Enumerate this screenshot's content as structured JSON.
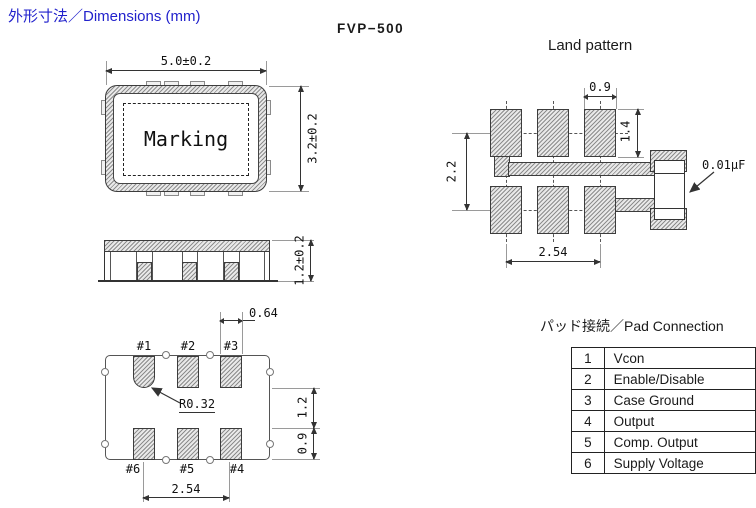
{
  "header": {
    "title": "外形寸法／Dimensions (mm)",
    "title_color": "#2222cc",
    "model": "FVP−500"
  },
  "top_view": {
    "marking_label": "Marking",
    "dim_width": "5.0±0.2",
    "dim_height": "3.2±0.2"
  },
  "side_view": {
    "dim_thickness": "1.2±0.2"
  },
  "bottom_view": {
    "pad_labels": [
      "#1",
      "#2",
      "#3",
      "#4",
      "#5",
      "#6"
    ],
    "dim_pad_width": "0.64",
    "radius_label": "R0.32",
    "dim_pad_pitch": "2.54",
    "dim_row_gap": "1.2",
    "dim_pad_height": "0.9"
  },
  "land_pattern": {
    "title": "Land pattern",
    "dim_pad_width": "0.9",
    "dim_pad_height": "1.4",
    "dim_row_pitch": "2.2",
    "dim_col_pitch": "2.54",
    "capacitor_label": "0.01μF"
  },
  "pad_connection": {
    "title": "パッド接続／Pad Connection",
    "rows": [
      {
        "no": "1",
        "name": "Vcon"
      },
      {
        "no": "2",
        "name": "Enable/Disable"
      },
      {
        "no": "3",
        "name": "Case Ground"
      },
      {
        "no": "4",
        "name": "Output"
      },
      {
        "no": "5",
        "name": "Comp. Output"
      },
      {
        "no": "6",
        "name": "Supply Voltage"
      }
    ]
  }
}
